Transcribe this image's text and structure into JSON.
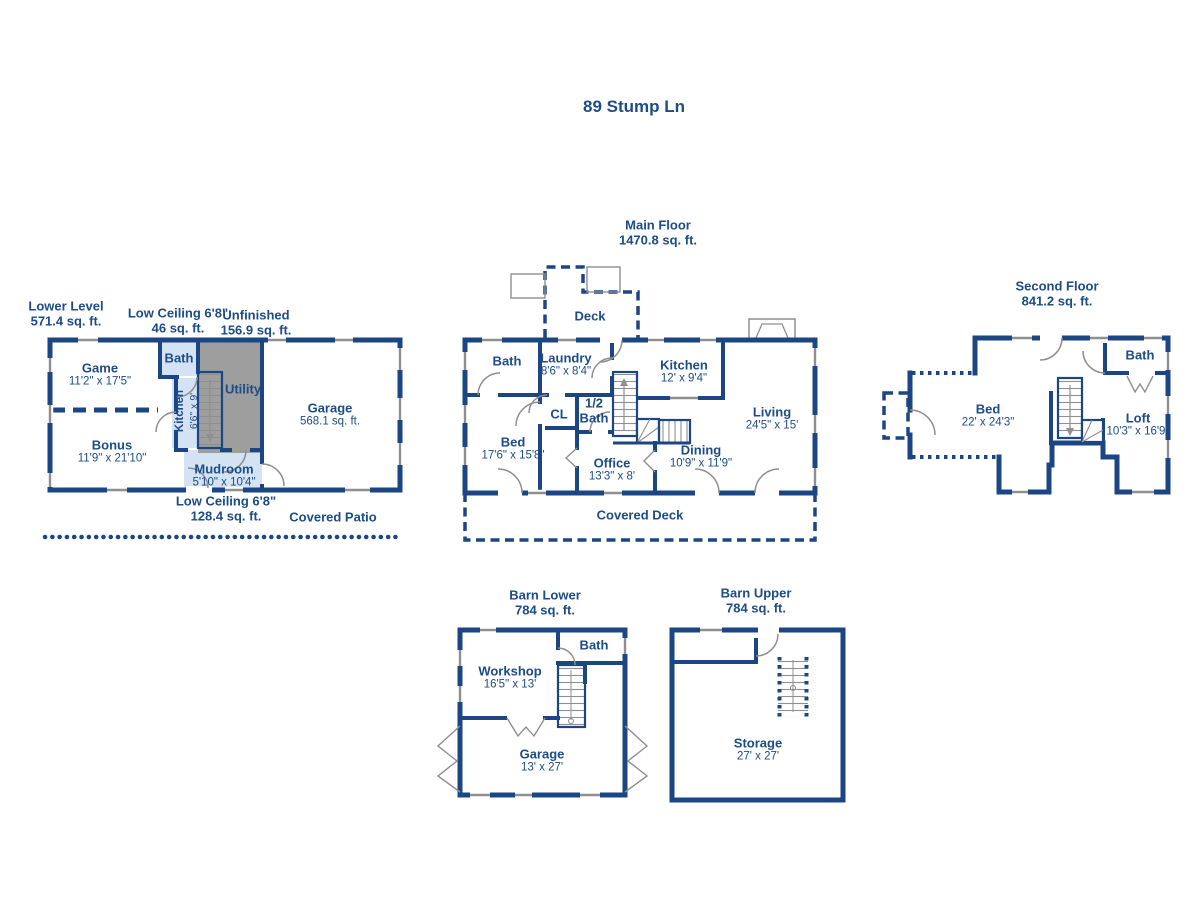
{
  "title": "89 Stump Ln",
  "colors": {
    "wall": "#1c4583",
    "text": "#1d4c87",
    "room_fill_bath": "#d4e3f3",
    "room_fill_utility": "#9e9e9e",
    "window_door": "#8f8f8f",
    "background": "#ffffff"
  },
  "floors": {
    "lower_level": {
      "title": "Lower Level",
      "area": "571.4 sq. ft.",
      "annotations": {
        "low_ceiling_top": {
          "label": "Low Ceiling 6'8\"",
          "area": "46 sq. ft."
        },
        "unfinished": {
          "label": "Unfinished",
          "area": "156.9 sq. ft."
        },
        "low_ceiling_bottom": {
          "label": "Low Ceiling 6'8\"",
          "area": "128.4 sq. ft."
        },
        "covered_patio": "Covered Patio"
      },
      "rooms": {
        "game": {
          "name": "Game",
          "dims": "11'2\" x 17'5\""
        },
        "bonus": {
          "name": "Bonus",
          "dims": "11'9\" x 21'10\""
        },
        "bath": {
          "name": "Bath"
        },
        "kitchen": {
          "name": "Kitchen",
          "dims": "6'6\" x 9'"
        },
        "utility": {
          "name": "Utility"
        },
        "mudroom": {
          "name": "Mudroom",
          "dims": "5'10\" x 10'4\""
        },
        "garage": {
          "name": "Garage",
          "dims": "568.1 sq. ft."
        }
      }
    },
    "main_floor": {
      "title": "Main Floor",
      "area": "1470.8 sq. ft.",
      "rooms": {
        "deck": {
          "name": "Deck"
        },
        "bath": {
          "name": "Bath"
        },
        "laundry": {
          "name": "Laundry",
          "dims": "8'6\" x 8'4\""
        },
        "kitchen": {
          "name": "Kitchen",
          "dims": "12' x 9'4\""
        },
        "cl": {
          "name": "CL"
        },
        "half_bath": {
          "line1": "1/2",
          "line2": "Bath"
        },
        "bed": {
          "name": "Bed",
          "dims": "17'6\" x 15'8\""
        },
        "office": {
          "name": "Office",
          "dims": "13'3\" x 8'"
        },
        "dining": {
          "name": "Dining",
          "dims": "10'9\" x 11'9\""
        },
        "living": {
          "name": "Living",
          "dims": "24'5\" x 15'"
        },
        "covered_deck": {
          "name": "Covered Deck"
        }
      }
    },
    "second_floor": {
      "title": "Second Floor",
      "area": "841.2 sq. ft.",
      "rooms": {
        "bed": {
          "name": "Bed",
          "dims": "22' x 24'3\""
        },
        "loft": {
          "name": "Loft",
          "dims": "10'3\" x 16'9\""
        },
        "bath": {
          "name": "Bath"
        }
      }
    },
    "barn_lower": {
      "title": "Barn Lower",
      "area": "784 sq. ft.",
      "rooms": {
        "workshop": {
          "name": "Workshop",
          "dims": "16'5\" x 13'"
        },
        "bath": {
          "name": "Bath"
        },
        "garage": {
          "name": "Garage",
          "dims": "13' x 27'"
        }
      }
    },
    "barn_upper": {
      "title": "Barn Upper",
      "area": "784 sq. ft.",
      "rooms": {
        "storage": {
          "name": "Storage",
          "dims": "27' x 27'"
        }
      }
    }
  }
}
